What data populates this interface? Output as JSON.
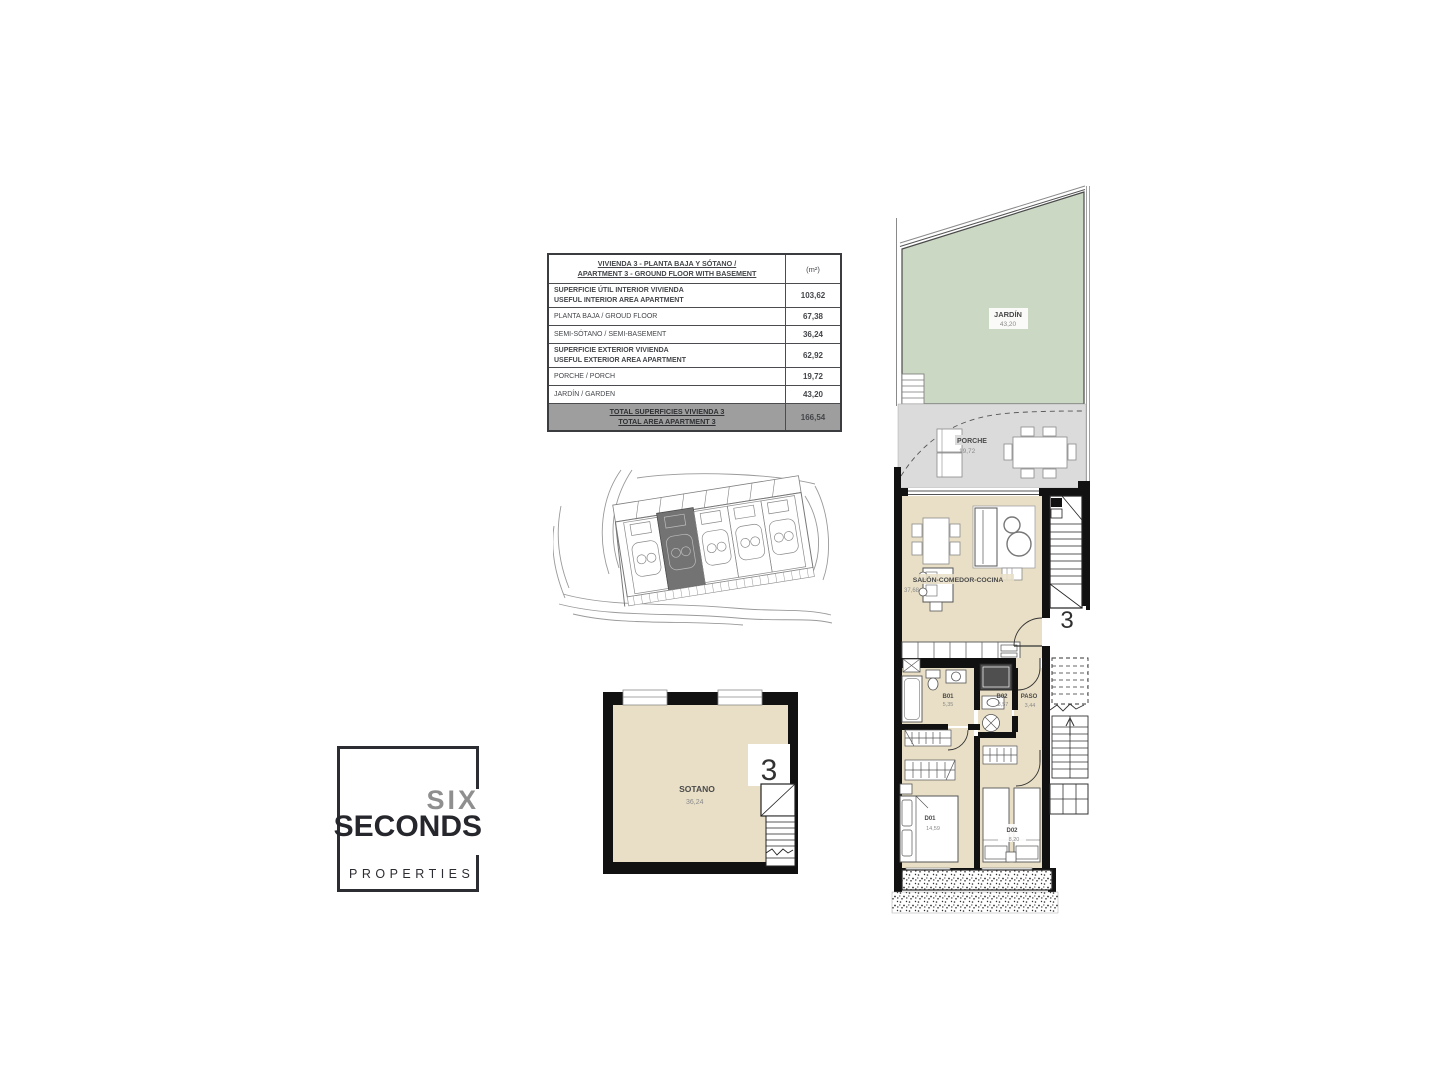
{
  "colors": {
    "interior_beige": "#e9dfc6",
    "garden_green": "#cbd8c3",
    "porch_gray": "#dbdbdb",
    "wall_black": "#111111",
    "table_footer_gray": "#9e9e9e",
    "logo_dark": "#26262d",
    "logo_gray": "#8f8f8f",
    "highlight_plot_gray": "#737373"
  },
  "area_table": {
    "header": {
      "title": "VIVIENDA 3 - PLANTA BAJA Y SÓTANO /\nAPARTMENT 3 - GROUND FLOOR WITH BASEMENT",
      "unit": "(m²)"
    },
    "rows": [
      {
        "label": "SUPERFICIE ÚTIL INTERIOR VIVIENDA\nUSEFUL INTERIOR AREA APARTMENT",
        "value": "103,62"
      },
      {
        "label": "PLANTA BAJA / GROUD FLOOR",
        "value": "67,38"
      },
      {
        "label": "SEMI-SÓTANO / SEMI-BASEMENT",
        "value": "36,24"
      },
      {
        "label": "SUPERFICIE EXTERIOR VIVIENDA\nUSEFUL EXTERIOR AREA APARTMENT",
        "value": "62,92"
      },
      {
        "label": "PORCHE / PORCH",
        "value": "19,72"
      },
      {
        "label": "JARDÍN / GARDEN",
        "value": "43,20"
      }
    ],
    "footer": {
      "label": "TOTAL SUPERFICIES VIVIENDA 3\nTOTAL AREA APARTMENT 3",
      "value": "166,54"
    }
  },
  "logo": {
    "six": "SIX",
    "seconds": "SECONDS",
    "properties": "PROPERTIES"
  },
  "basement_plan": {
    "room_label": "SOTANO",
    "room_area": "36,24",
    "unit_number": "3"
  },
  "floor_plan": {
    "unit_number": "3",
    "rooms": {
      "jardin": {
        "label": "JARDÍN",
        "area": "43,20"
      },
      "porche": {
        "label": "PORCHE",
        "area": "19,72"
      },
      "salon": {
        "label": "SALÓN-COMEDOR-COCINA",
        "area": "37,68"
      },
      "b01": {
        "label": "B01",
        "area": "5,35"
      },
      "b02": {
        "label": "B02",
        "area": "3,57"
      },
      "paso": {
        "label": "PASO",
        "area": "3,44"
      },
      "d01": {
        "label": "D01",
        "area": "14,59"
      },
      "d02": {
        "label": "D02",
        "area": "8,20"
      }
    }
  }
}
